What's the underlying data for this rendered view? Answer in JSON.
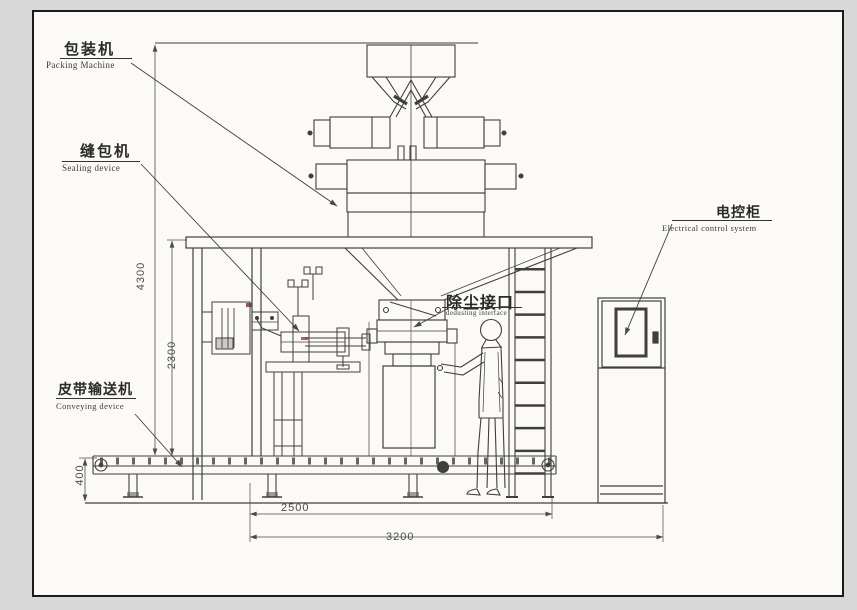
{
  "drawing_title": "bag packing machine general arrangement",
  "colors": {
    "background": "#d8d8d8",
    "paper": "#fbfaf6",
    "line": "#3f3f3f"
  },
  "labels": {
    "packing": {
      "zh": "包装机",
      "en": "Packing Machine"
    },
    "sealing": {
      "zh": "缝包机",
      "en": "Sealing device"
    },
    "electrical": {
      "zh": "电控柜",
      "en": "Electrical control system"
    },
    "dedusting": {
      "zh": "除尘接口",
      "en": "dedusting interface"
    },
    "conveying": {
      "zh": "皮带输送机",
      "en": "Conveying device"
    }
  },
  "dims": {
    "total_height": "4300",
    "platform_height": "2300",
    "conveyor_height": "400",
    "span_inner": "2500",
    "span_outer": "3200"
  }
}
